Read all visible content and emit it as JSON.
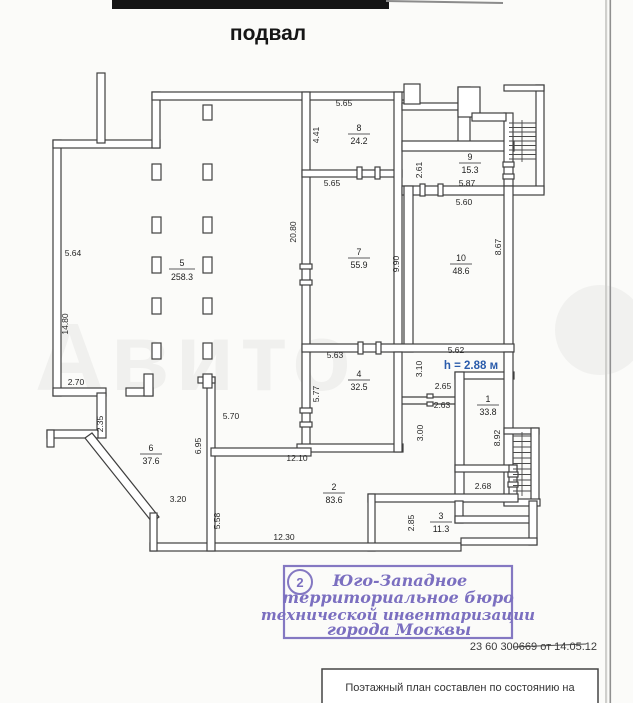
{
  "page": {
    "title": "подвал",
    "ref_number": "23 60 300669 от 14.05.12",
    "bottom_caption": "Поэтажный план составлен по состоянию на",
    "watermark": "Авито"
  },
  "plan": {
    "height_note": "h = 2.88 м",
    "rooms": [
      {
        "number": "1",
        "area": "33.8"
      },
      {
        "number": "2",
        "area": "83.6"
      },
      {
        "number": "3",
        "area": "11.3"
      },
      {
        "number": "4",
        "area": "32.5"
      },
      {
        "number": "5",
        "area": "258.3"
      },
      {
        "number": "6",
        "area": "37.6"
      },
      {
        "number": "7",
        "area": "55.9"
      },
      {
        "number": "8",
        "area": "24.2"
      },
      {
        "number": "9",
        "area": "15.3"
      },
      {
        "number": "10",
        "area": "48.6"
      }
    ],
    "dimensions": [
      "5.64",
      "14.80",
      "2.70",
      "2.35",
      "20.80",
      "4.41",
      "5.65",
      "5.65",
      "2.61",
      "5.87",
      "5.60",
      "8.67",
      "9.90",
      "5.63",
      "5.62",
      "3.10",
      "5.77",
      "2.65",
      "2.63",
      "3.00",
      "8.92",
      "5.70",
      "6.95",
      "12.10",
      "3.20",
      "5.58",
      "12.30",
      "2.85",
      "2.68"
    ]
  },
  "stamp": {
    "number": "2",
    "lines": [
      "Юго-Западное",
      "территориальное бюро",
      "технической инвентаризации",
      "города Москвы"
    ]
  }
}
